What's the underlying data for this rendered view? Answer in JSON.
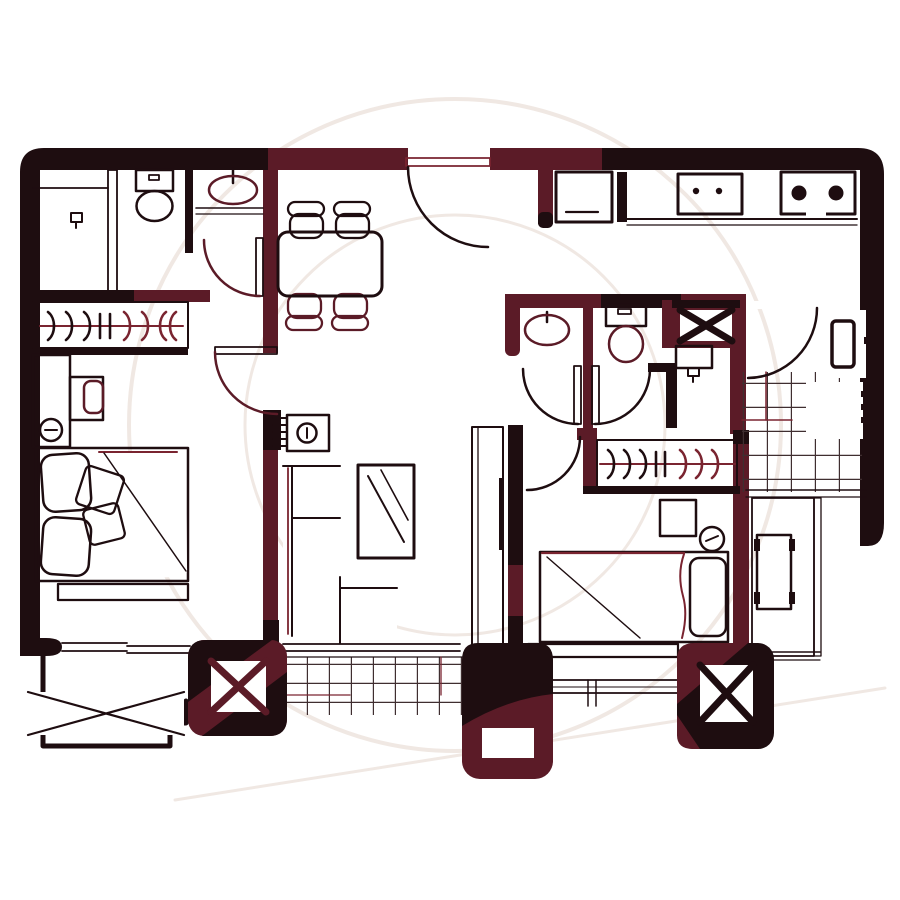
{
  "title": "two-bedroom-apartment-floor-plan",
  "colors": {
    "background": "#ffffff",
    "ink": "#1e0d10",
    "maroon": "#5b1b27",
    "maroon_line": "#7a2430",
    "tile_line": "#3f2e30",
    "watermark": "#f0e8e3"
  },
  "watermark": {
    "outer_ring_radius": 326,
    "inner_ring_radius": 210
  },
  "rooms": [
    {
      "name": "main-bathroom",
      "fixtures": [
        "laundry-sink",
        "toilet",
        "wash-basin",
        "vanity-counter",
        "swing-door"
      ]
    },
    {
      "name": "master-bedroom",
      "fixtures": [
        "wardrobe-with-hangers",
        "dresser",
        "table-lamp",
        "nightstand",
        "double-bed",
        "pillows",
        "cushions",
        "foot-bench",
        "entry-door",
        "window"
      ]
    },
    {
      "name": "dining-room",
      "fixtures": [
        "dining-table",
        "chair",
        "chair",
        "chair",
        "chair"
      ]
    },
    {
      "name": "entry",
      "fixtures": [
        "entry-door",
        "refrigerator"
      ]
    },
    {
      "name": "kitchen",
      "fixtures": [
        "counter",
        "kitchen-sink",
        "two-burner-cooktop"
      ]
    },
    {
      "name": "second-bathroom",
      "fixtures": [
        "wash-basin",
        "toilet",
        "duct-shaft",
        "utility-sink",
        "swing-door",
        "swing-door"
      ]
    },
    {
      "name": "service-balcony",
      "fixtures": [
        "swing-door",
        "water-heater",
        "washing-machine",
        "tile-floor"
      ]
    },
    {
      "name": "living-room",
      "fixtures": [
        "ac-unit",
        "radiator-hatch",
        "l-shaped-sofa",
        "coffee-table",
        "tv-console",
        "tv"
      ]
    },
    {
      "name": "second-bedroom",
      "fixtures": [
        "wardrobe-with-hangers",
        "nightstand",
        "table-lamp",
        "bed",
        "pillow",
        "foot-board",
        "window",
        "desk-alcove",
        "desk"
      ]
    },
    {
      "name": "front-balcony",
      "fixtures": [
        "ac-platform-x",
        "tile-floor",
        "stepped-parapet"
      ]
    },
    {
      "name": "structure",
      "fixtures": [
        "shaft-column-left-x",
        "service-column-center",
        "shaft-column-right-x"
      ]
    }
  ]
}
